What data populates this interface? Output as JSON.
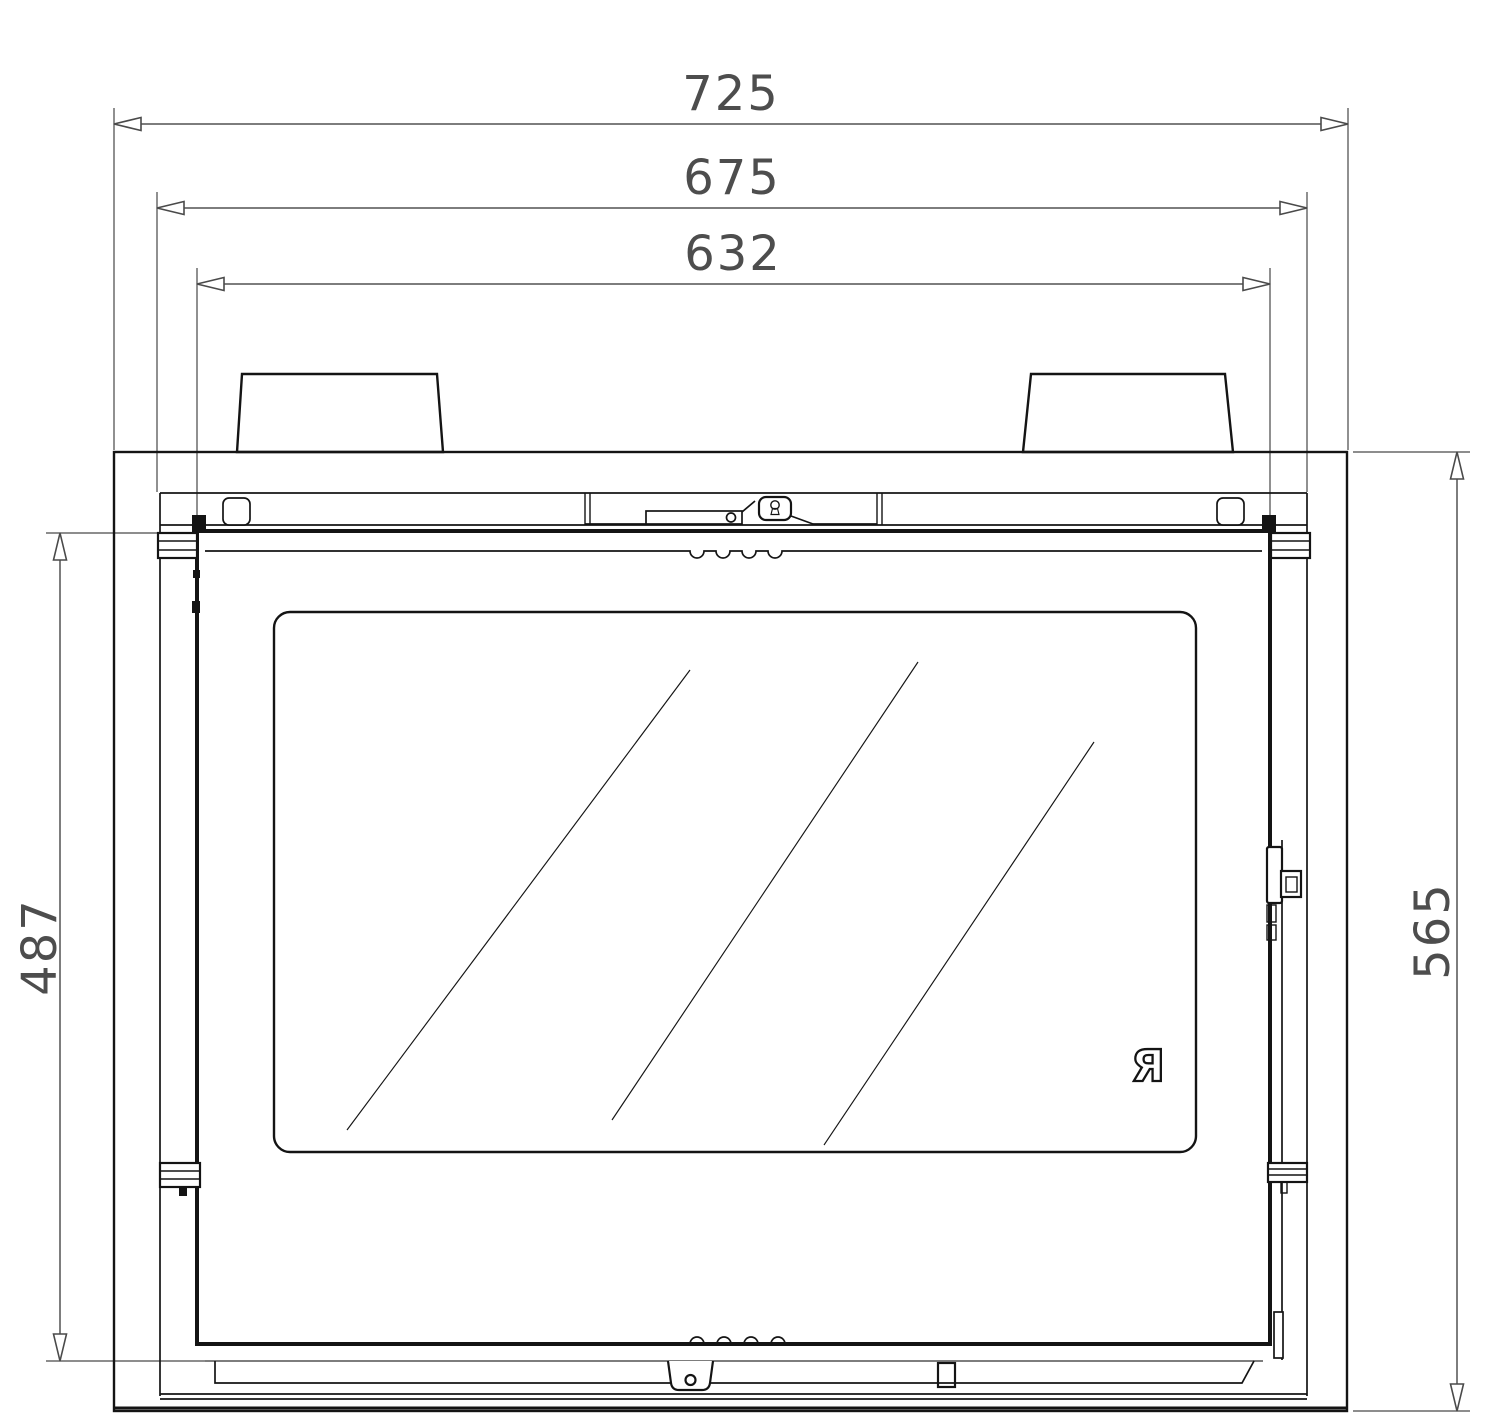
{
  "drawing": {
    "dimensions": {
      "top": [
        {
          "id": "overall-width",
          "label": "725"
        },
        {
          "id": "frame-width",
          "label": "675"
        },
        {
          "id": "door-width",
          "label": "632"
        }
      ],
      "left": {
        "id": "door-height",
        "label": "487"
      },
      "right": {
        "id": "overall-height",
        "label": "565"
      }
    },
    "logo": "Я",
    "colors": {
      "line": "#141414",
      "dimension_line": "#7d7d7d",
      "dimension_text": "#4d4d4d",
      "background": "#ffffff"
    }
  }
}
